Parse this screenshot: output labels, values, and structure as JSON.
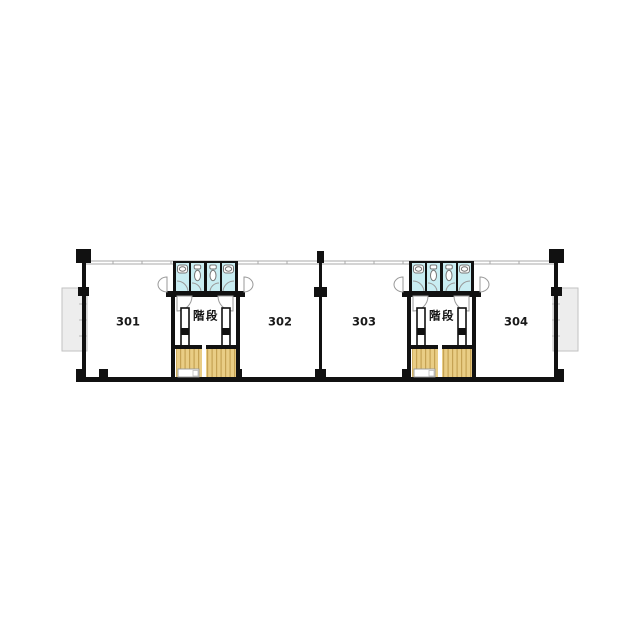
{
  "plan": {
    "type": "floor-plan",
    "units": [
      {
        "stair_label": "階段",
        "rooms": [
          {
            "number": "301"
          },
          {
            "number": "302"
          }
        ]
      },
      {
        "stair_label": "階段",
        "rooms": [
          {
            "number": "303"
          },
          {
            "number": "304"
          }
        ]
      }
    ]
  },
  "colors": {
    "wall": "#111111",
    "stall_fill": "#c9edf2",
    "stair_fill": "#e9cd85",
    "stair_stripe": "#c5a253",
    "balcony_fill": "#ededed",
    "door_arc": "#999999",
    "fixture_stroke": "#777777",
    "label": "#1a1a1a"
  },
  "icons": {
    "sink": "sink-icon",
    "toilet": "toilet-icon",
    "door_swing": "door-swing-arc"
  }
}
